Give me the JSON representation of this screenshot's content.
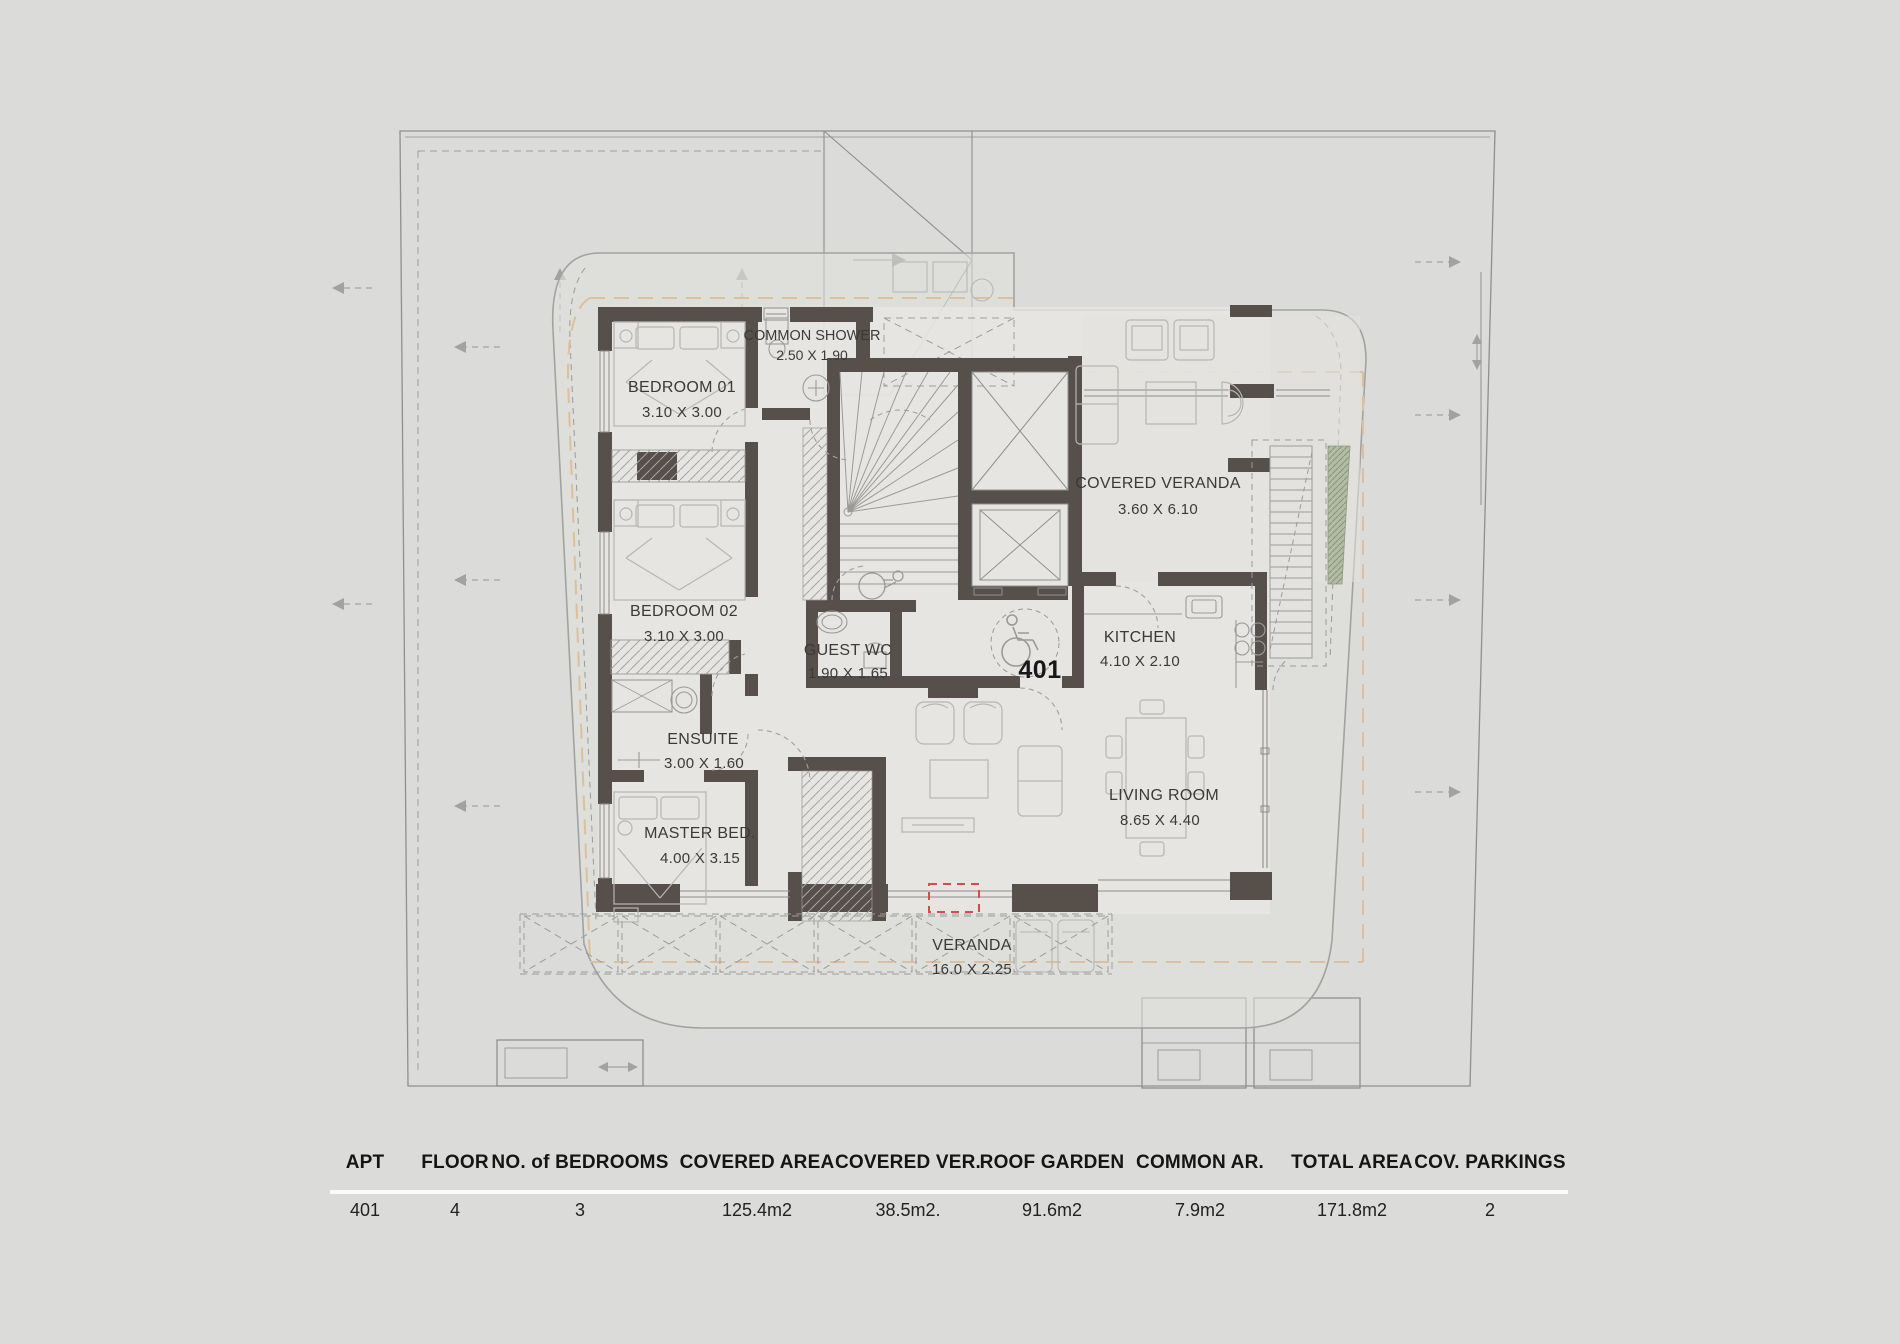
{
  "plan": {
    "apartment_number": "401",
    "rooms": [
      {
        "name": "COMMON SHOWER",
        "dims": "2.50 X 1.90"
      },
      {
        "name": "BEDROOM 01",
        "dims": "3.10 X 3.00"
      },
      {
        "name": "BEDROOM 02",
        "dims": "3.10 X 3.00"
      },
      {
        "name": "ENSUITE",
        "dims": "3.00 X 1.60"
      },
      {
        "name": "MASTER BED.",
        "dims": "4.00 X 3.15"
      },
      {
        "name": "GUEST WC",
        "dims": "1.90 X 1.65"
      },
      {
        "name": "KITCHEN",
        "dims": "4.10 X 2.10"
      },
      {
        "name": "COVERED VERANDA",
        "dims": "3.60 X 6.10"
      },
      {
        "name": "LIVING ROOM",
        "dims": "8.65 X 4.40"
      },
      {
        "name": "VERANDA",
        "dims": "16.0 X 2.25"
      }
    ],
    "colors": {
      "wall": "#57504a",
      "background": "#dbdbda",
      "door_marker_red": "#cf4f4f",
      "planting_green": "#b2bba4",
      "setback_orange": "#ddc09a"
    }
  },
  "table": {
    "columns": [
      "APT",
      "FLOOR",
      "NO. of BEDROOMS",
      "COVERED AREA",
      "COVERED VER.",
      "ROOF GARDEN",
      "COMMON AR.",
      "TOTAL AREA",
      "COV. PARKINGS"
    ],
    "values": [
      "401",
      "4",
      "3",
      "125.4m2",
      "38.5m2.",
      "91.6m2",
      "7.9m2",
      "171.8m2",
      "2"
    ]
  }
}
